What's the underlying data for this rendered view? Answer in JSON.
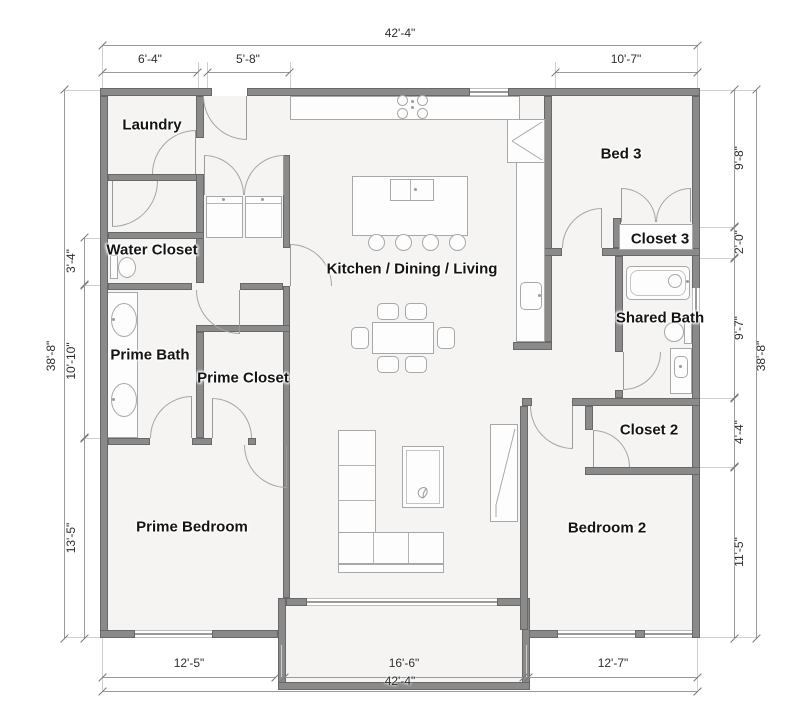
{
  "rooms": {
    "laundry": "Laundry",
    "water_closet": "Water Closet",
    "prime_bath": "Prime Bath",
    "prime_closet": "Prime Closet",
    "prime_bedroom": "Prime Bedroom",
    "kitchen_dining_living": "Kitchen / Dining / Living",
    "bed3": "Bed 3",
    "closet3": "Closet 3",
    "shared_bath": "Shared Bath",
    "closet2": "Closet 2",
    "bedroom2": "Bedroom 2"
  },
  "dims": {
    "top_total": "42'-4\"",
    "top_left": "6'-4\"",
    "top_mid": "5'-8\"",
    "top_right": "10'-7\"",
    "left_total": "38'-8\"",
    "left_s1": "3'-4\"",
    "left_s2": "10'-10\"",
    "left_s3": "13'-5\"",
    "right_s1": "9'-8\"",
    "right_s2": "2'-0\"",
    "right_s3": "9'-7\"",
    "right_s4": "4'-4\"",
    "right_s5": "11'-5\"",
    "right_total": "38'-8\"",
    "bottom_left": "12'-5\"",
    "bottom_mid": "16'-6\"",
    "bottom_right": "12'-7\"",
    "bottom_total": "42'-4\""
  },
  "colors": {
    "wall": "#8a8a8a",
    "wall_edge": "#686868",
    "floor": "#f5f4f2",
    "fixture_line": "#a8a8a8",
    "dimension_line": "#9a9a9a",
    "label_text": "#141414",
    "dimension_text": "#2e2e2e",
    "background": "#ffffff"
  }
}
